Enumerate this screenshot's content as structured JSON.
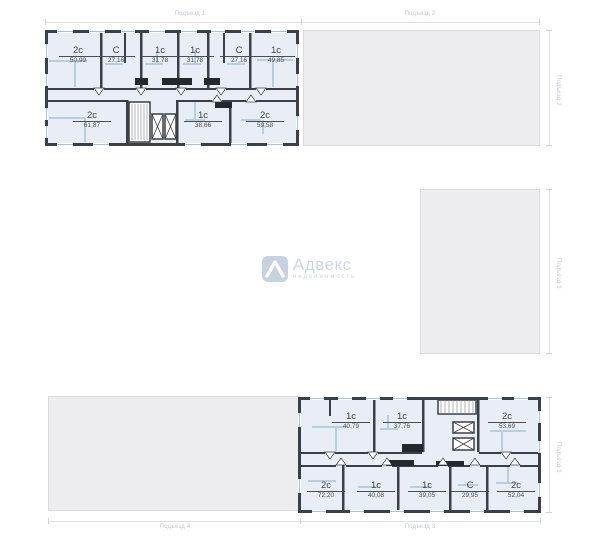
{
  "colors": {
    "wall": "#3b4047",
    "unit_fill": "#e9edf5",
    "partition": "#b7cde0",
    "window": "#a9c3d8",
    "shaft_black": "#23282d",
    "inactive_block": "#ededef",
    "dim_label": "#c2c8d2",
    "area_text": "#3f444b",
    "watermark": "#ccd6e2"
  },
  "dim_labels": {
    "top": [
      "Подъезд 1",
      "Подъезд 2"
    ],
    "right": [
      "Подъезд 2",
      "Подъезд 3",
      "Подъезд 3"
    ],
    "bottom": [
      "Подъезд 4",
      "Подъезд 3"
    ]
  },
  "plans": {
    "entrance1": {
      "name": "Подъезд 1",
      "units": [
        {
          "type": "2с",
          "area": "50,99"
        },
        {
          "type": "С",
          "area": "27,16"
        },
        {
          "type": "1с",
          "area": "31,78"
        },
        {
          "type": "1с",
          "area": "31,78"
        },
        {
          "type": "С",
          "area": "27,16"
        },
        {
          "type": "1с",
          "area": "49,85"
        },
        {
          "type": "2с",
          "area": "61,87"
        },
        {
          "type": "1с",
          "area": "38,66"
        },
        {
          "type": "2с",
          "area": "59,58"
        }
      ]
    },
    "entrance3": {
      "name": "Подъезд 3",
      "units": [
        {
          "type": "1с",
          "area": "40,79"
        },
        {
          "type": "1с",
          "area": "37,76"
        },
        {
          "type": "2с",
          "area": "53,69"
        },
        {
          "type": "2с",
          "area": "72,20"
        },
        {
          "type": "1с",
          "area": "40,08"
        },
        {
          "type": "1с",
          "area": "39,05"
        },
        {
          "type": "С",
          "area": "29,95"
        },
        {
          "type": "2с",
          "area": "52,04"
        }
      ]
    }
  },
  "watermark": {
    "brand": "Адвекс",
    "subtitle": "недвижимость"
  }
}
